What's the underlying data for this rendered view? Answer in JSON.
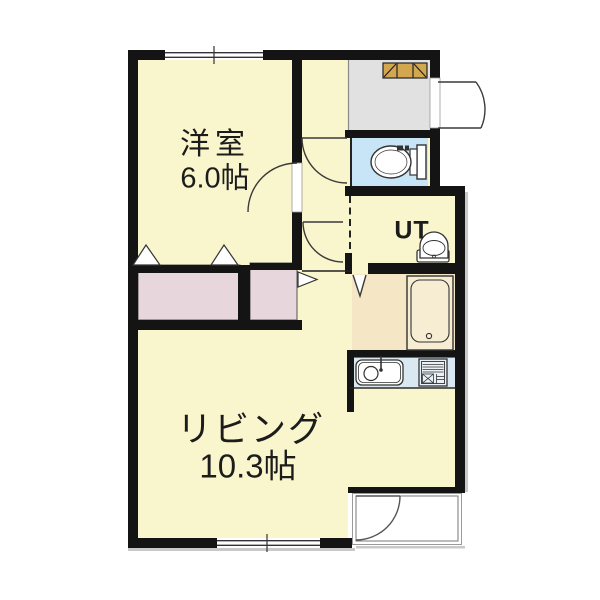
{
  "floorplan": {
    "labels": {
      "western_name": "洋室",
      "western_size": "6.0帖",
      "living_name": "リビング",
      "living_size": "10.3帖",
      "ut": "UT"
    },
    "rooms": [
      {
        "id": "western-room",
        "name": "洋室",
        "size": "6.0帖"
      },
      {
        "id": "living-room",
        "name": "リビング",
        "size": "10.3帖"
      },
      {
        "id": "utility-room",
        "name": "UT"
      },
      {
        "id": "toilet-room",
        "name": ""
      },
      {
        "id": "bath-room",
        "name": ""
      },
      {
        "id": "kitchen",
        "name": ""
      },
      {
        "id": "entrance",
        "name": ""
      },
      {
        "id": "closet",
        "name": ""
      }
    ],
    "icons": [
      "toilet-icon",
      "washbasin-icon",
      "bathtub-icon",
      "kitchen-sink-icon",
      "stove-icon",
      "shoe-cabinet-icon",
      "door-swing-icon",
      "folding-door-icon",
      "window-icon"
    ],
    "colors": {
      "wall": "#141414",
      "room_yellow": "#F9F5CC",
      "closet_pink": "#E7D7DC",
      "entrance_gray": "#E1E1E1",
      "toilet_blue": "#C8E4F7",
      "bath_beige": "#F5E7C5",
      "kitchen_blue": "#D9E8F1",
      "cabinet_tan": "#D2A74F",
      "fixture_white": "#FFFFFF",
      "line_dark": "#333333",
      "shadow_gray": "#C9C9C9"
    }
  }
}
